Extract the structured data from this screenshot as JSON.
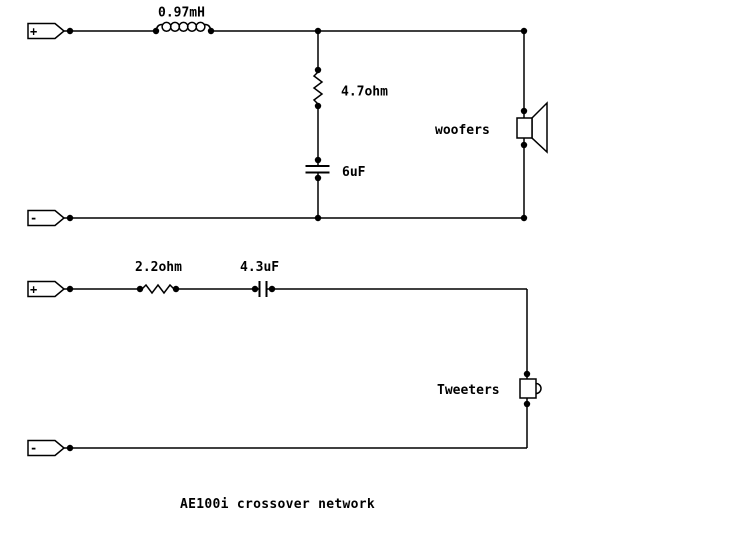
{
  "diagram": {
    "caption": "AE100i crossover network",
    "woofer_circuit": {
      "positive_terminal": "+",
      "negative_terminal": "-",
      "inductor_label": "0.97mH",
      "resistor_label": "4.7ohm",
      "capacitor_label": "6uF",
      "speaker_label": "woofers"
    },
    "tweeter_circuit": {
      "positive_terminal": "+",
      "negative_terminal": "-",
      "resistor_label": "2.2ohm",
      "capacitor_label": "4.3uF",
      "speaker_label": "Tweeters"
    },
    "colors": {
      "wire": "#000000",
      "background": "#ffffff"
    }
  }
}
